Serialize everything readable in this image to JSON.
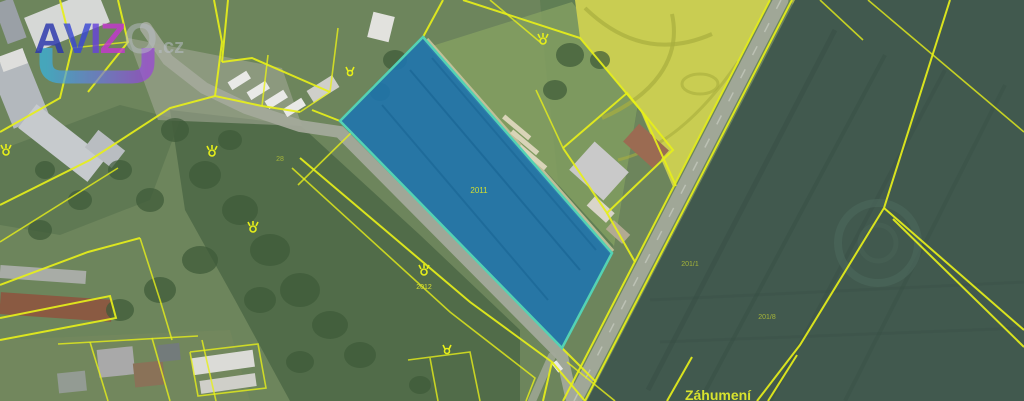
{
  "watermark": {
    "letters": [
      {
        "ch": "A"
      },
      {
        "ch": "V"
      },
      {
        "ch": "I"
      },
      {
        "ch": "Z"
      },
      {
        "ch": "O"
      }
    ],
    "tld": ".cz"
  },
  "colors": {
    "boundary-yellow": "#e6ef1a",
    "label-yellow": "#d8e22e",
    "parcel-fill": "#1f74ad",
    "parcel-border": "#54d2b4",
    "field-rapeseed": "#c9cd52",
    "field-dark": "#41594e",
    "village-green": "#6d855c",
    "road-grey": "#a3a99a",
    "logo-a": "#2a35ad",
    "logo-v": "#3a49d4",
    "logo-i": "#6742da",
    "logo-z": "#c436cf",
    "logo-grey": "#b9bec7",
    "logo-u-start": "#35b6e8",
    "logo-u-end": "#9b3fe0"
  },
  "map": {
    "highlighted_parcel_number": "2011",
    "labels": {
      "parcel_2011": "2011",
      "parcel_2012": "2012",
      "parcel_201_1": "201/1",
      "parcel_201_8": "201/8",
      "parcel_28": "28",
      "place_name": "Záhumení"
    }
  }
}
